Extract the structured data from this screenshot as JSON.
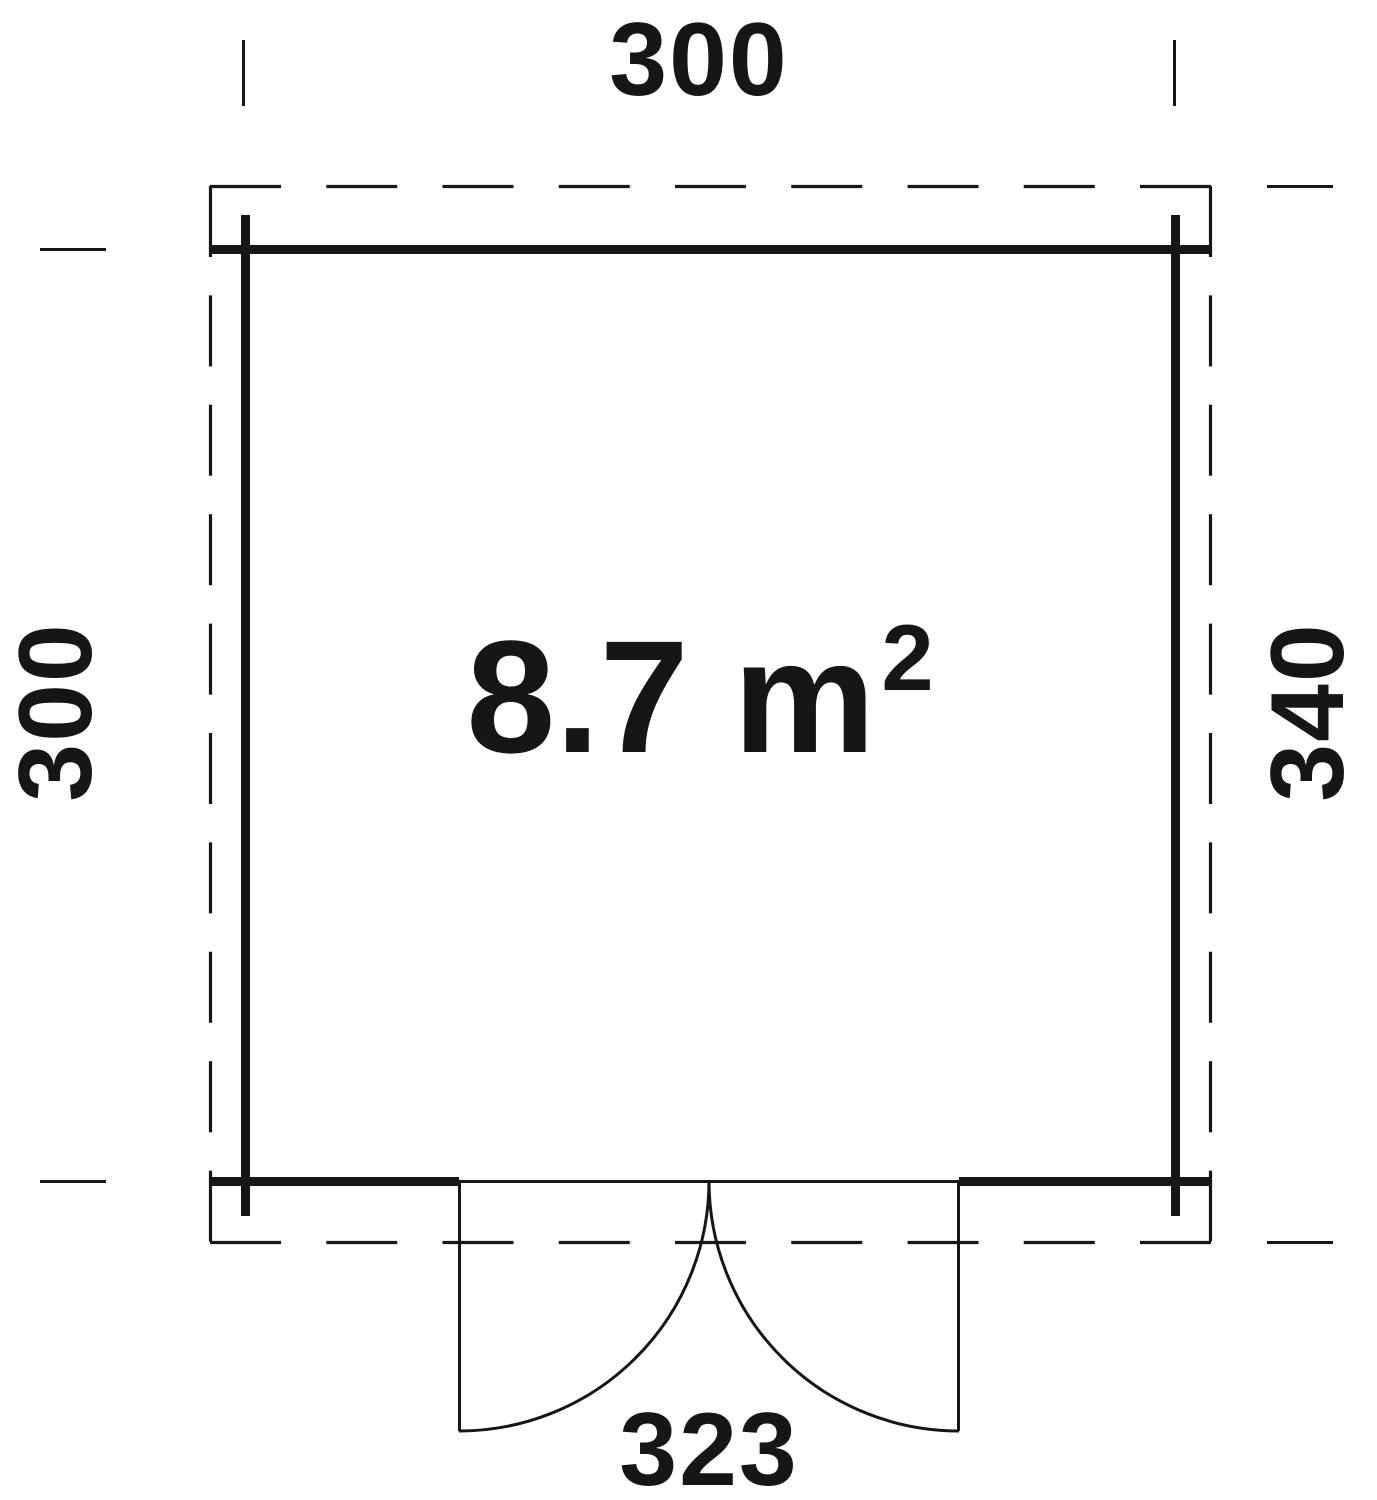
{
  "diagram": {
    "type": "floor-plan",
    "description": "Garden house / shed floor plan with double door",
    "area_label": {
      "value": "8.7 m",
      "superscript": "2"
    },
    "dimensions": {
      "top": "300",
      "left": "300",
      "right": "340",
      "bottom": "323"
    },
    "colors": {
      "line": "#161616",
      "background": "#ffffff"
    }
  }
}
